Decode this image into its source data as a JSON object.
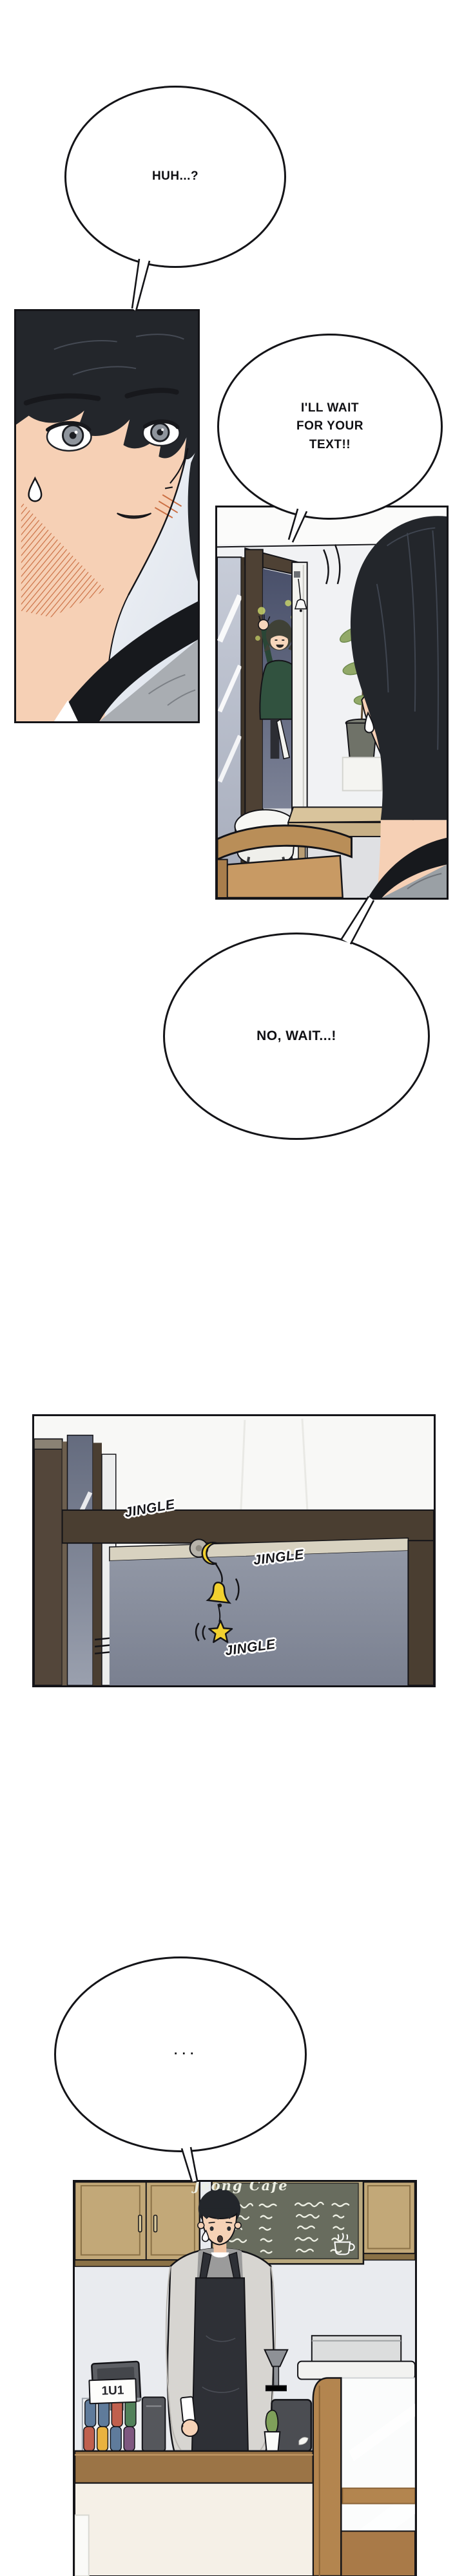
{
  "page": {
    "kind": "webtoon comic page",
    "background": "#ffffff"
  },
  "bubbles": {
    "b1": {
      "text": "HUH...?"
    },
    "b2": {
      "lines": [
        "I'LL WAIT",
        "FOR YOUR",
        "TEXT!!"
      ]
    },
    "b3": {
      "text": "NO, WAIT...!"
    },
    "b4": {
      "text": "· · ·"
    }
  },
  "sfx": {
    "jingle_a": "JINGLE",
    "jingle_b": "JINGLE",
    "jingle_c": "JINGLE"
  },
  "cafe": {
    "chalkboard_title": "Jeong Cafe",
    "register_sign": "1U1"
  },
  "colors": {
    "bell_yellow": "#f2d12f",
    "sweater_green": "#31523f",
    "wood_counter": "#9b7446",
    "chalkboard": "#686c5e",
    "blush": "#cb6f43",
    "hair_black": "#23262b",
    "skin": "#f6d0b5",
    "apron_black": "#2e3036",
    "frame_brown": "#4a3e31"
  }
}
